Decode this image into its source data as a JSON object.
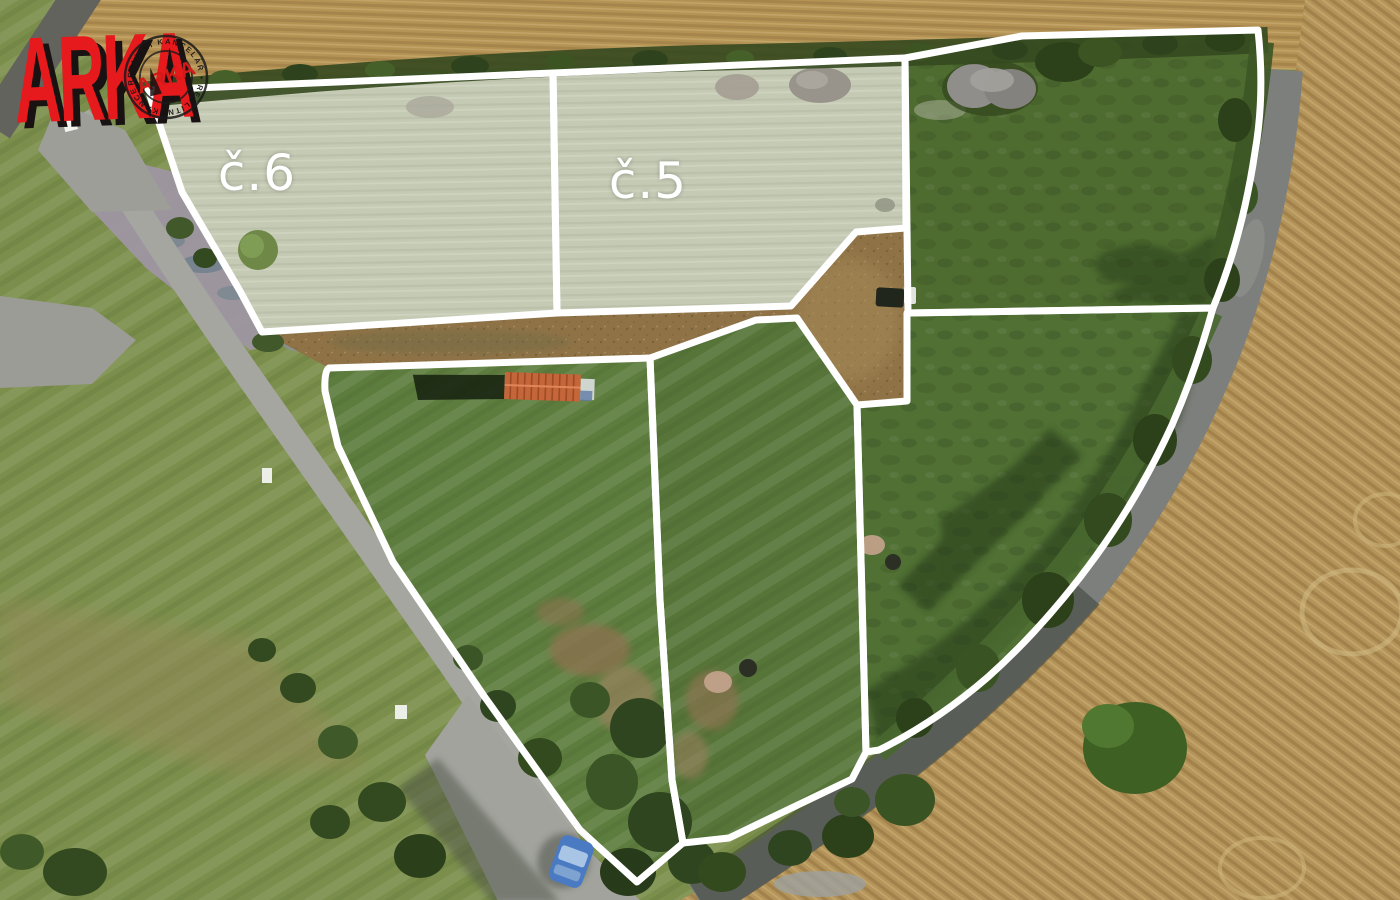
{
  "branding": {
    "logo_text": "ARKA",
    "stamp_center": "ARKA",
    "stamp_arc": "REALITNÍ KANCELÁŘ • REALITNÍ KANCELÁŘ •"
  },
  "parcels": {
    "parcel6_label": "č.6",
    "parcel5_label": "č.5"
  },
  "colors": {
    "boundary_line": "#ffffff",
    "logo_red": "#e6191c",
    "tinted_parcel": "#c5cab5",
    "dark_parcel_green": "#4e6c30",
    "meadow_green": "#7b8e4b",
    "dirt_brown": "#8f7346",
    "wheat_tan": "#b3955c",
    "asphalt_gray": "#7d7f7c",
    "gravel_gray": "#a3a49e",
    "shed_roof_orange": "#c4653a",
    "car_blue": "#4a7ac2"
  }
}
